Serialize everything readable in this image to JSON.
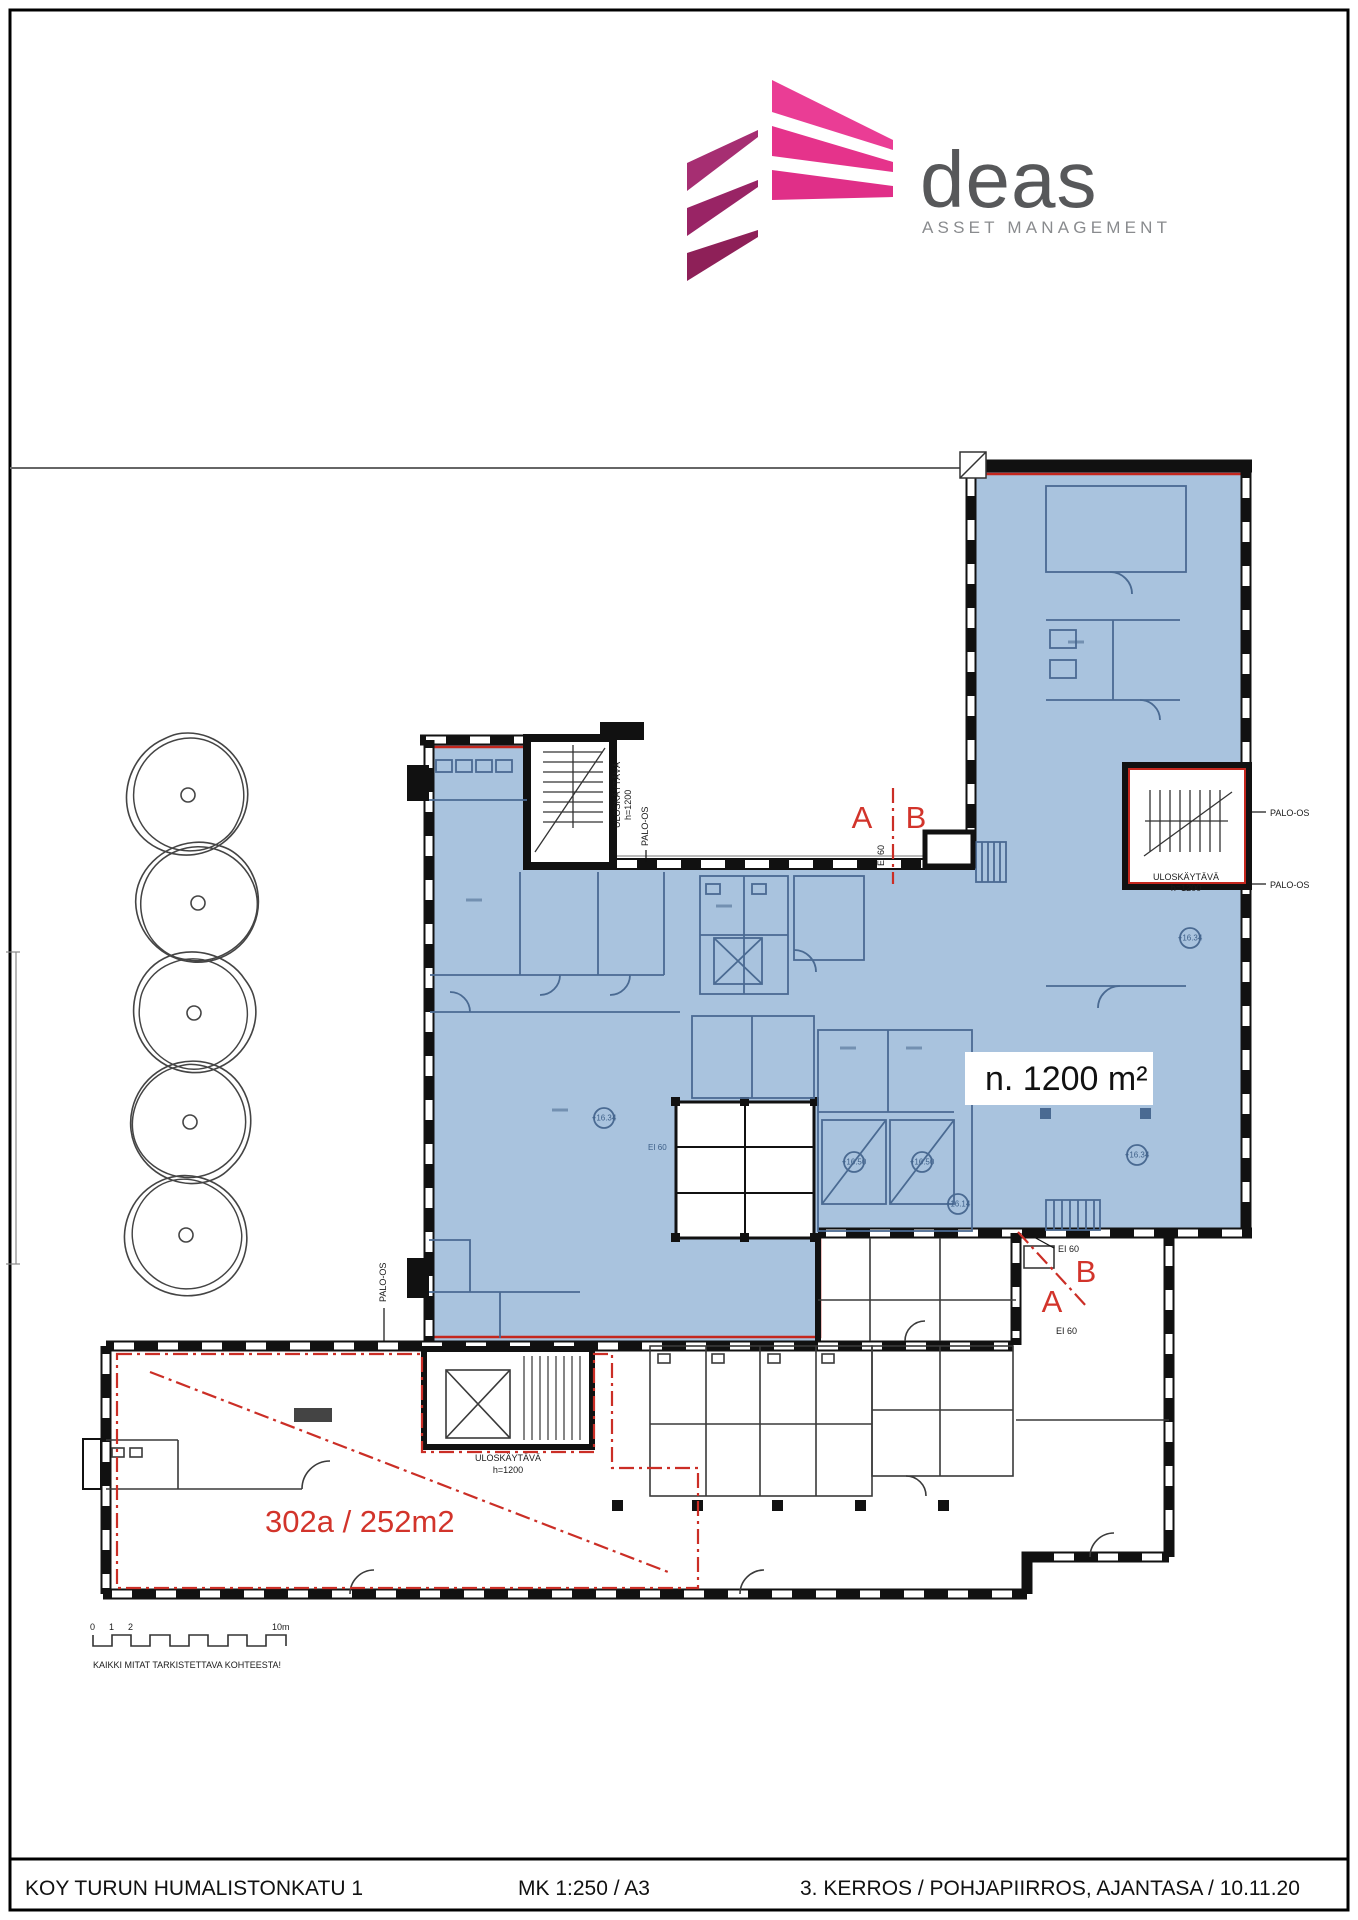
{
  "page": {
    "header": {
      "brand": "deas",
      "tagline": "ASSET MANAGEMENT"
    },
    "plan": {
      "area_label": "n. 1200 m²",
      "unit_label": "302a / 252m2",
      "marker_a": "A",
      "marker_b": "B",
      "palo_os": "PALO-OS",
      "ei60": "EI 60",
      "stair_exit": "ULOSKÄYTÄVÄ",
      "stair_height": "h=1200",
      "elev": {
        "e1": "+16.34",
        "e2": "+16.50",
        "e3": "+16.14"
      }
    },
    "scalebar": {
      "t0": "0",
      "t1": "1",
      "t2": "2",
      "t10": "10m",
      "note": "KAIKKI MITAT TARKISTETTAVA KOHTEESTA!"
    },
    "footer": {
      "left": "KOY TURUN HUMALISTONKATU 1",
      "center": "MK 1:250 / A3",
      "right": "3. KERROS / POHJAPIIRROS, AJANTASA / 10.11.20"
    },
    "colors": {
      "highlight_blue": "#a9c3de",
      "annotation_red": "#cb2e26",
      "logo_pink": "#e5338b",
      "logo_magenta": "#9e2a6b",
      "logo_gray": "#57585a"
    }
  }
}
